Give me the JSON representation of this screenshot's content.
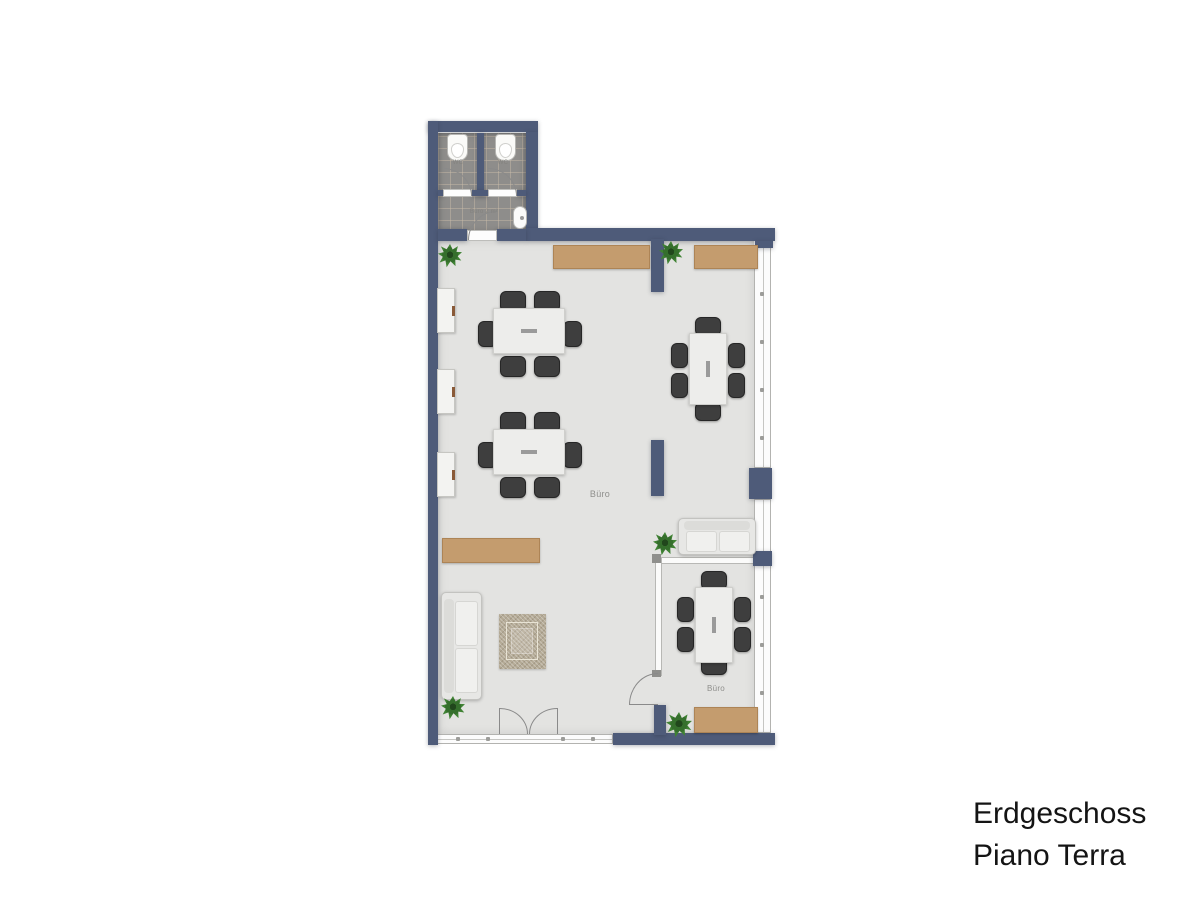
{
  "plan": {
    "labels": {
      "main_office": "Büro",
      "small_office": "Büro",
      "wc_left": "WC",
      "wc_right": "WC",
      "vestibule": "Büro 2 m²"
    }
  },
  "caption": {
    "line1": "Erdgeschoss",
    "line2": "Piano Terra"
  },
  "colors": {
    "wall": "#4e5b79",
    "floor": "#e3e3e1",
    "tile": "#8e8d8b",
    "wood": "#c49c6e",
    "chair": "#3e3e3e",
    "table": "#ededeb",
    "plant": "#3c7c31",
    "rug": "#b4aa96",
    "room-label": "#8f8f8c",
    "caption": "#141414"
  }
}
